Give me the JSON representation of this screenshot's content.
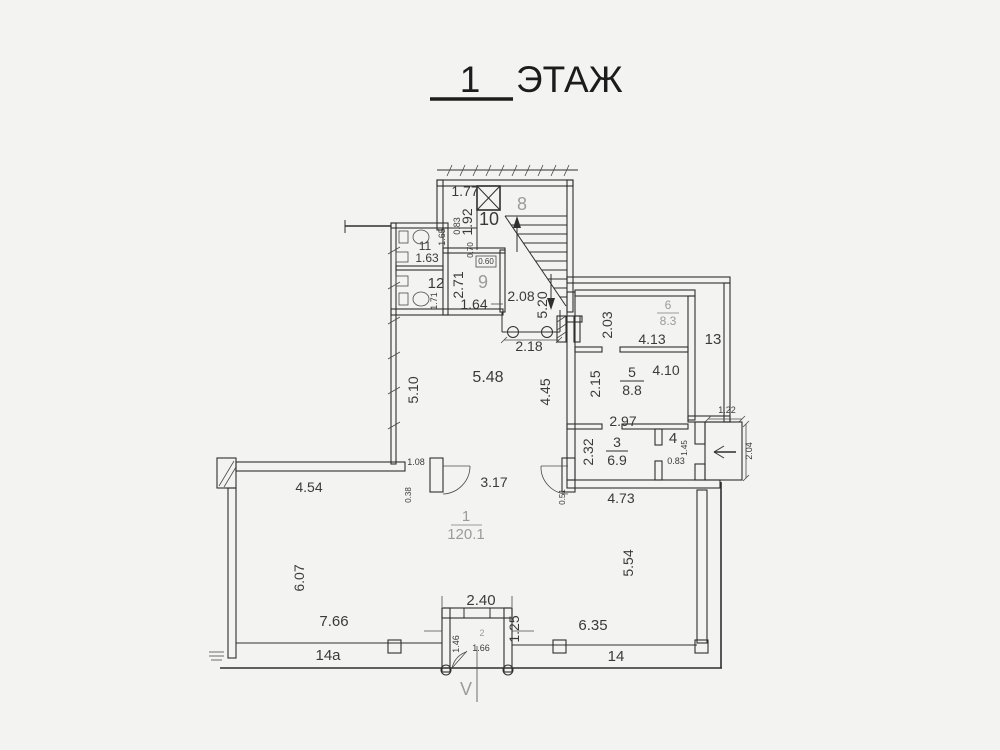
{
  "title": {
    "floor_number": "1",
    "floor_word": "ЭТАЖ"
  },
  "rooms": [
    {
      "number": "1",
      "area": "120.1"
    },
    {
      "number": "2",
      "area": ""
    },
    {
      "number": "3",
      "area": "6.9"
    },
    {
      "number": "4",
      "area": ""
    },
    {
      "number": "5",
      "area": "8.8"
    },
    {
      "number": "6",
      "area": "8.3"
    },
    {
      "number": "8",
      "area": ""
    },
    {
      "number": "9",
      "area": ""
    },
    {
      "number": "10",
      "area": ""
    },
    {
      "number": "11",
      "area": ""
    },
    {
      "number": "12",
      "area": ""
    },
    {
      "number": "13",
      "area": ""
    },
    {
      "number": "14",
      "area": ""
    },
    {
      "number": "14a",
      "area": ""
    }
  ],
  "labels": {
    "floor_number": "1",
    "floor_word": "ЭТАЖ",
    "d_177": "1.77",
    "r_10": "10",
    "d_192": "1.92",
    "d_083_top": "0.83",
    "r_8": "8",
    "r_11": "11",
    "d_163": "1.63",
    "d_165": "1.65",
    "r_12": "12",
    "d_171": "1.71",
    "d_271": "2.71",
    "r_9": "9",
    "d_070": "0.70",
    "d_060": "0.60",
    "d_164": "1.64",
    "d_208": "2.08",
    "d_520": "5.20",
    "d_218": "2.18",
    "d_548": "5.48",
    "d_510": "5.10",
    "d_445": "4.45",
    "d_203": "2.03",
    "r_6": "6",
    "a_6": "8.3",
    "d_413": "4.13",
    "r_13": "13",
    "d_215": "2.15",
    "r_5": "5",
    "a_5": "8.8",
    "d_410": "4.10",
    "d_297": "2.97",
    "d_232": "2.32",
    "r_3": "3",
    "a_3": "6.9",
    "r_4": "4",
    "d_083_r4": "0.83",
    "d_145": "1.45",
    "d_122": "1.22",
    "d_204": "2.04",
    "d_473": "4.73",
    "d_317": "3.17",
    "d_108": "1.08",
    "d_038": "0.38",
    "d_051": "0.51",
    "d_454": "4.54",
    "r_1": "1",
    "a_1": "120.1",
    "d_607": "6.07",
    "d_554": "5.54",
    "d_766": "7.66",
    "r_14a": "14a",
    "d_240": "2.40",
    "d_146": "1.46",
    "r_2": "2",
    "d_166": "1.66",
    "d_125": "1.25",
    "d_635": "6.35",
    "r_14": "14",
    "entrance_mark": "V"
  },
  "colors": {
    "ink": "#2f2f2f",
    "muted": "#9b9b9b",
    "background": "#f3f3f2"
  }
}
